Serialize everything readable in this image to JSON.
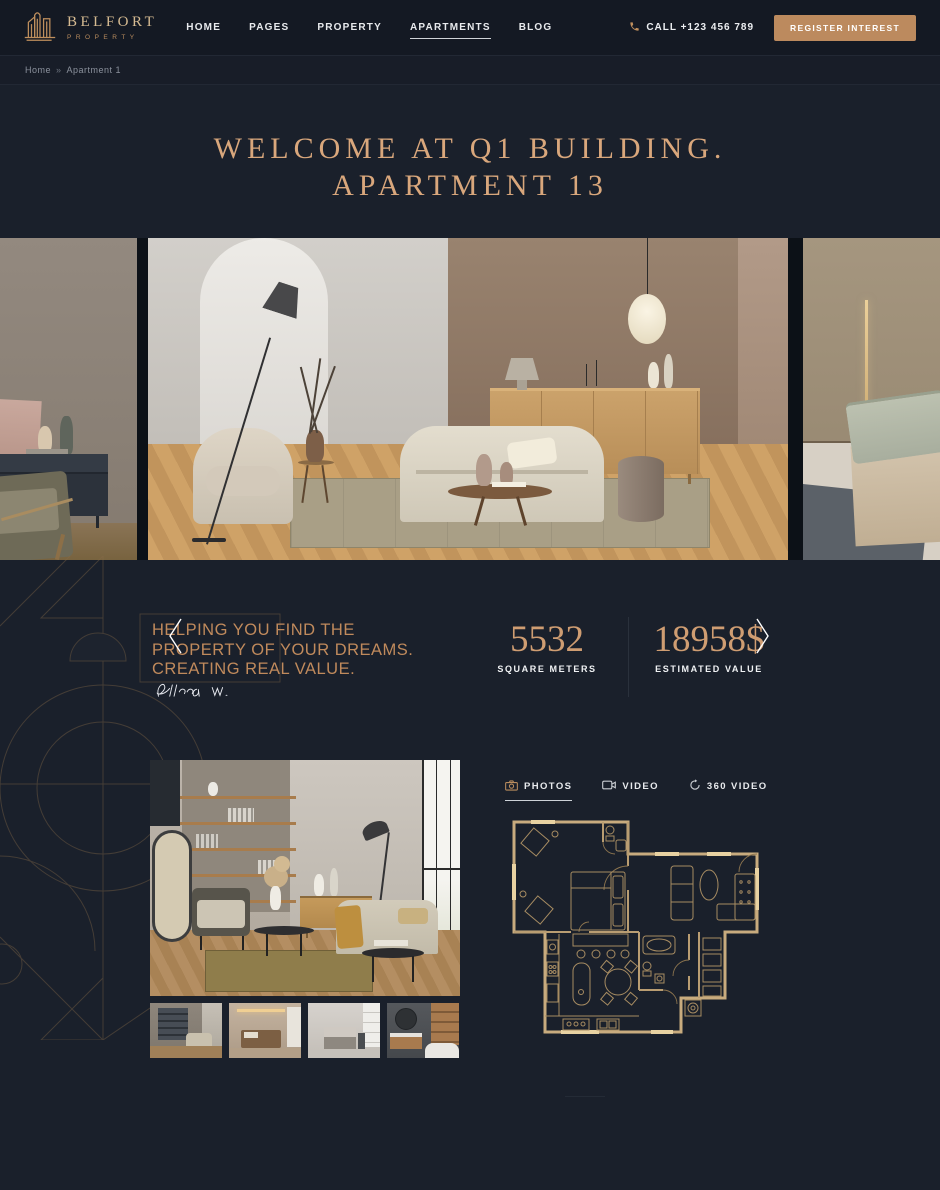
{
  "colors": {
    "page_bg": "#1a202b",
    "header_bg": "#141923",
    "accent_gold": "#bc8a5e",
    "title_gold": "#d9a77c",
    "quote_gold": "#c08a5c",
    "stat_gold": "#cf9d72",
    "text_light": "#e8eaed"
  },
  "header": {
    "brand_name": "BELFORT",
    "brand_tagline": "PROPERTY",
    "nav": [
      {
        "label": "HOME",
        "active": false
      },
      {
        "label": "PAGES",
        "active": false
      },
      {
        "label": "PROPERTY",
        "active": false
      },
      {
        "label": "APARTMENTS",
        "active": true
      },
      {
        "label": "BLOG",
        "active": false
      }
    ],
    "call_label": "CALL +123 456 789",
    "register_label": "REGISTER INTEREST"
  },
  "breadcrumb": {
    "home": "Home",
    "separator": "»",
    "current": "Apartment 1"
  },
  "hero": {
    "title_line1": "WELCOME AT Q1 BUILDING.",
    "title_line2": "APARTMENT 13"
  },
  "carousel": {
    "slides": [
      "living-room-partial-left",
      "living-room-main",
      "bedroom-partial-right"
    ],
    "prev_icon": "chevron-left",
    "next_icon": "chevron-right"
  },
  "about": {
    "quote_line1": "HELPING YOU FIND THE",
    "quote_line2": "PROPERTY OF YOUR DREAMS.",
    "quote_line3": "CREATING REAL VALUE.",
    "signature": "Ellena W.",
    "stats": [
      {
        "value": "5532",
        "label": "SQUARE METERS"
      },
      {
        "value": "18958$",
        "label": "ESTIMATED VALUE"
      }
    ]
  },
  "gallery": {
    "tabs": [
      {
        "label": "PHOTOS",
        "icon": "camera-icon",
        "active": true
      },
      {
        "label": "VIDEO",
        "icon": "video-camera-icon",
        "active": false
      },
      {
        "label": "360 VIDEO",
        "icon": "rotate-360-icon",
        "active": false
      }
    ],
    "thumbnails": [
      "living-room",
      "bedroom",
      "kitchen",
      "bathroom"
    ],
    "floor_plan": "apartment-floor-plan"
  }
}
